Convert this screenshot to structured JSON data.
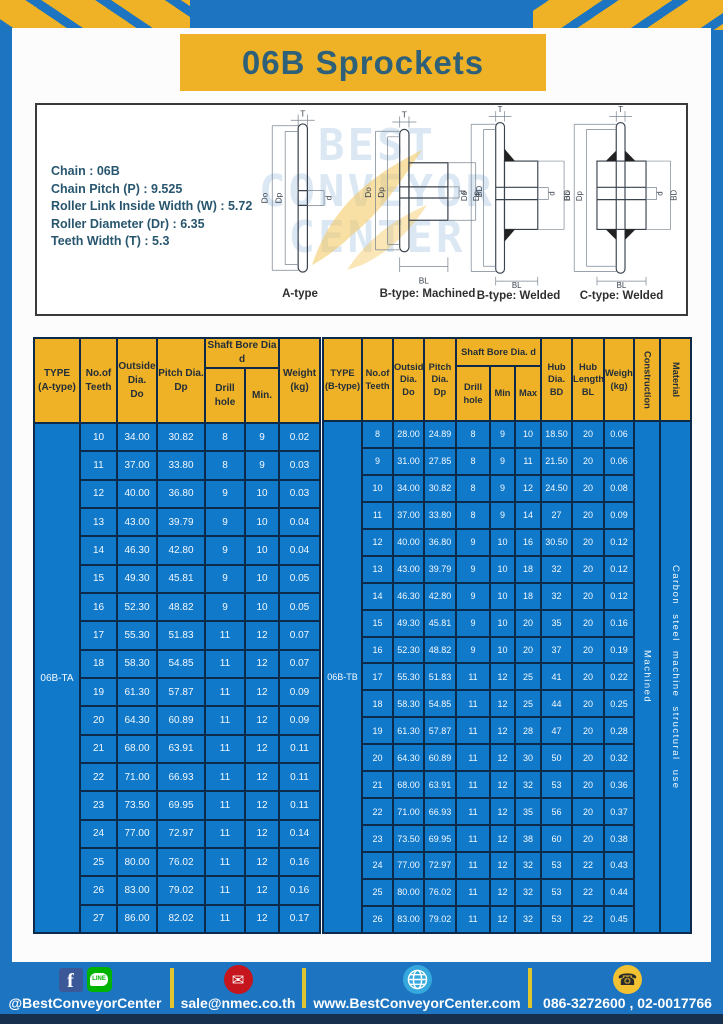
{
  "title": "06B Sprockets",
  "colors": {
    "frame_blue": "#1d74c0",
    "cell_blue": "#1179ca",
    "accent_yellow": "#efb226",
    "border_navy": "#0d2a4a",
    "bottom_navy": "#16304e",
    "title_text": "#2e6079"
  },
  "specs": {
    "lines": [
      "Chain  : 06B",
      "Chain Pitch (P)  :  9.525",
      "Roller Link Inside Width (W)  :  5.72",
      "Roller Diameter (Dr)  : 6.35",
      "Teeth Width (T)  :  5.3"
    ]
  },
  "diagram": {
    "labels": [
      "A-type",
      "B-type: Machined",
      "B-type: Welded",
      "C-type: Welded"
    ],
    "dims": {
      "t": "T",
      "dout": "Do",
      "dp": "Dp",
      "d": "d",
      "bd": "BD",
      "bl": "BL"
    },
    "watermark_lines": [
      "BEST",
      "CONVEYOR",
      "CENTER"
    ]
  },
  "table_a": {
    "type_label": "06B-TA",
    "headers": {
      "type": "TYPE\n(A-type)",
      "teeth": "No.of\nTeeth",
      "outside": "Outside\nDia.\nDo",
      "pitch": "Pitch Dia.\nDp",
      "shaft": "Shaft Bore Dia d",
      "drill": "Drill hole",
      "min": "Min.",
      "weight": "Weight\n(kg)"
    },
    "rows": [
      [
        "10",
        "34.00",
        "30.82",
        "8",
        "9",
        "0.02"
      ],
      [
        "11",
        "37.00",
        "33.80",
        "8",
        "9",
        "0.03"
      ],
      [
        "12",
        "40.00",
        "36.80",
        "9",
        "10",
        "0.03"
      ],
      [
        "13",
        "43.00",
        "39.79",
        "9",
        "10",
        "0.04"
      ],
      [
        "14",
        "46.30",
        "42.80",
        "9",
        "10",
        "0.04"
      ],
      [
        "15",
        "49.30",
        "45.81",
        "9",
        "10",
        "0.05"
      ],
      [
        "16",
        "52.30",
        "48.82",
        "9",
        "10",
        "0.05"
      ],
      [
        "17",
        "55.30",
        "51.83",
        "11",
        "12",
        "0.07"
      ],
      [
        "18",
        "58.30",
        "54.85",
        "11",
        "12",
        "0.07"
      ],
      [
        "19",
        "61.30",
        "57.87",
        "11",
        "12",
        "0.09"
      ],
      [
        "20",
        "64.30",
        "60.89",
        "11",
        "12",
        "0.09"
      ],
      [
        "21",
        "68.00",
        "63.91",
        "11",
        "12",
        "0.11"
      ],
      [
        "22",
        "71.00",
        "66.93",
        "11",
        "12",
        "0.11"
      ],
      [
        "23",
        "73.50",
        "69.95",
        "11",
        "12",
        "0.11"
      ],
      [
        "24",
        "77.00",
        "72.97",
        "11",
        "12",
        "0.14"
      ],
      [
        "25",
        "80.00",
        "76.02",
        "11",
        "12",
        "0.16"
      ],
      [
        "26",
        "83.00",
        "79.02",
        "11",
        "12",
        "0.16"
      ],
      [
        "27",
        "86.00",
        "82.02",
        "11",
        "12",
        "0.17"
      ]
    ]
  },
  "table_b": {
    "type_label": "06B-TB",
    "construction": "Machined",
    "material": "Carbon steel machine structural use",
    "headers": {
      "type": "TYPE\n(B-type)",
      "teeth": "No.of\nTeeth",
      "outside": "Outside\nDia.\nDo",
      "pitch": "Pitch\nDia.\nDp",
      "shaft": "Shaft Bore Dia.  d",
      "drill": "Drill hole",
      "min": "Min",
      "max": "Max",
      "hub_dia": "Hub\nDia.\nBD",
      "hub_len": "Hub\nLength\nBL",
      "weight": "Weight\n(kg)",
      "construction": "Construction",
      "material": "Material"
    },
    "rows": [
      [
        "8",
        "28.00",
        "24.89",
        "8",
        "9",
        "10",
        "18.50",
        "20",
        "0.06"
      ],
      [
        "9",
        "31.00",
        "27.85",
        "8",
        "9",
        "11",
        "21.50",
        "20",
        "0.06"
      ],
      [
        "10",
        "34.00",
        "30.82",
        "8",
        "9",
        "12",
        "24.50",
        "20",
        "0.08"
      ],
      [
        "11",
        "37.00",
        "33.80",
        "8",
        "9",
        "14",
        "27",
        "20",
        "0.09"
      ],
      [
        "12",
        "40.00",
        "36.80",
        "9",
        "10",
        "16",
        "30.50",
        "20",
        "0.12"
      ],
      [
        "13",
        "43.00",
        "39.79",
        "9",
        "10",
        "18",
        "32",
        "20",
        "0.12"
      ],
      [
        "14",
        "46.30",
        "42.80",
        "9",
        "10",
        "18",
        "32",
        "20",
        "0.12"
      ],
      [
        "15",
        "49.30",
        "45.81",
        "9",
        "10",
        "20",
        "35",
        "20",
        "0.16"
      ],
      [
        "16",
        "52.30",
        "48.82",
        "9",
        "10",
        "20",
        "37",
        "20",
        "0.19"
      ],
      [
        "17",
        "55.30",
        "51.83",
        "11",
        "12",
        "25",
        "41",
        "20",
        "0.22"
      ],
      [
        "18",
        "58.30",
        "54.85",
        "11",
        "12",
        "25",
        "44",
        "20",
        "0.25"
      ],
      [
        "19",
        "61.30",
        "57.87",
        "11",
        "12",
        "28",
        "47",
        "20",
        "0.28"
      ],
      [
        "20",
        "64.30",
        "60.89",
        "11",
        "12",
        "30",
        "50",
        "20",
        "0.32"
      ],
      [
        "21",
        "68.00",
        "63.91",
        "11",
        "12",
        "32",
        "53",
        "20",
        "0.36"
      ],
      [
        "22",
        "71.00",
        "66.93",
        "11",
        "12",
        "35",
        "56",
        "20",
        "0.37"
      ],
      [
        "23",
        "73.50",
        "69.95",
        "11",
        "12",
        "38",
        "60",
        "20",
        "0.38"
      ],
      [
        "24",
        "77.00",
        "72.97",
        "11",
        "12",
        "32",
        "53",
        "22",
        "0.43"
      ],
      [
        "25",
        "80.00",
        "76.02",
        "11",
        "12",
        "32",
        "53",
        "22",
        "0.44"
      ],
      [
        "26",
        "83.00",
        "79.02",
        "11",
        "12",
        "32",
        "53",
        "22",
        "0.45"
      ]
    ]
  },
  "footer": {
    "social_label": "@BestConveyorCenter",
    "line_text": "LINE",
    "facebook_letter": "f",
    "email": "sale@nmec.co.th",
    "website": "www.BestConveyorCenter.com",
    "phone": "086-3272600 , 02-0017766",
    "mail_glyph": "✉",
    "phone_glyph": "☎"
  }
}
